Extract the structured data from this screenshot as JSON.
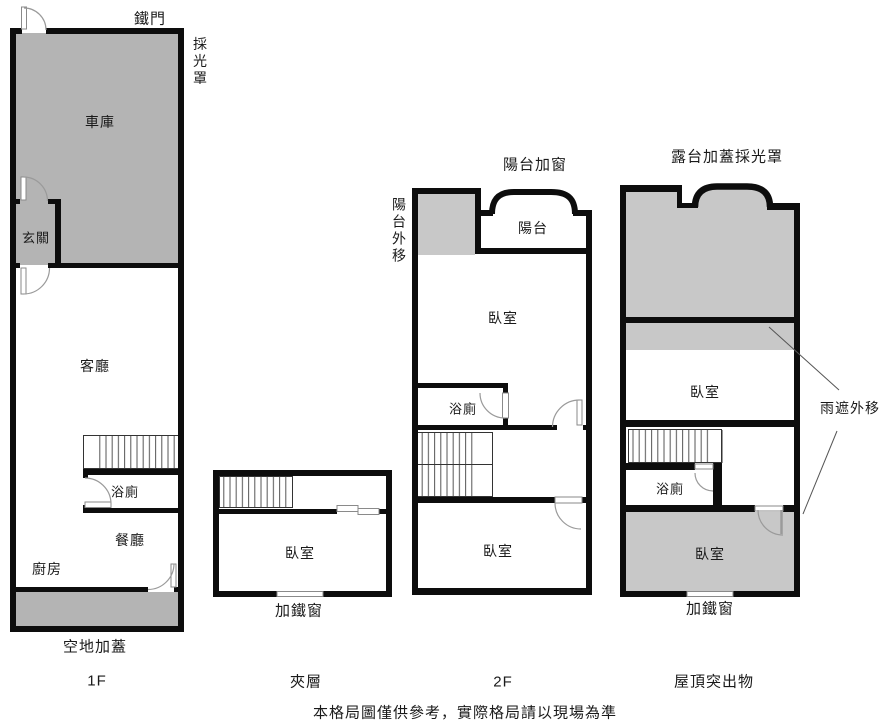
{
  "colors": {
    "wall": "#0d0d0d",
    "fill_gray": "#b4b4b4",
    "fill_light_gray": "#c8c8c8",
    "door_arc": "#9a9a9a",
    "stair_tread": "#555555",
    "pointer_line": "#555555"
  },
  "floor1": {
    "title": "1F",
    "annotations": {
      "iron_gate": "鐵門",
      "skylight": "採光罩",
      "yard_addition": "空地加蓋"
    },
    "rooms": {
      "garage": "車庫",
      "entry": "玄關",
      "living_room": "客廳",
      "bathroom": "浴廁",
      "dining_room": "餐廳",
      "kitchen": "廚房"
    }
  },
  "mezzanine": {
    "title": "夾層",
    "annotations": {
      "iron_window": "加鐵窗"
    },
    "rooms": {
      "bedroom": "臥室"
    }
  },
  "floor2": {
    "title": "2F",
    "annotations": {
      "balcony_window_added": "陽台加窗",
      "balcony_extended": "陽台外移"
    },
    "rooms": {
      "balcony": "陽台",
      "bedroom": "臥室",
      "bathroom": "浴廁"
    }
  },
  "roof": {
    "title": "屋頂突出物",
    "annotations": {
      "terrace_skylight": "露台加蓋採光罩",
      "rain_shelter_extended": "雨遮外移",
      "iron_window": "加鐵窗"
    },
    "rooms": {
      "bedroom": "臥室",
      "bathroom": "浴廁"
    }
  },
  "footer": {
    "disclaimer": "本格局圖僅供參考，實際格局請以現場為準"
  }
}
